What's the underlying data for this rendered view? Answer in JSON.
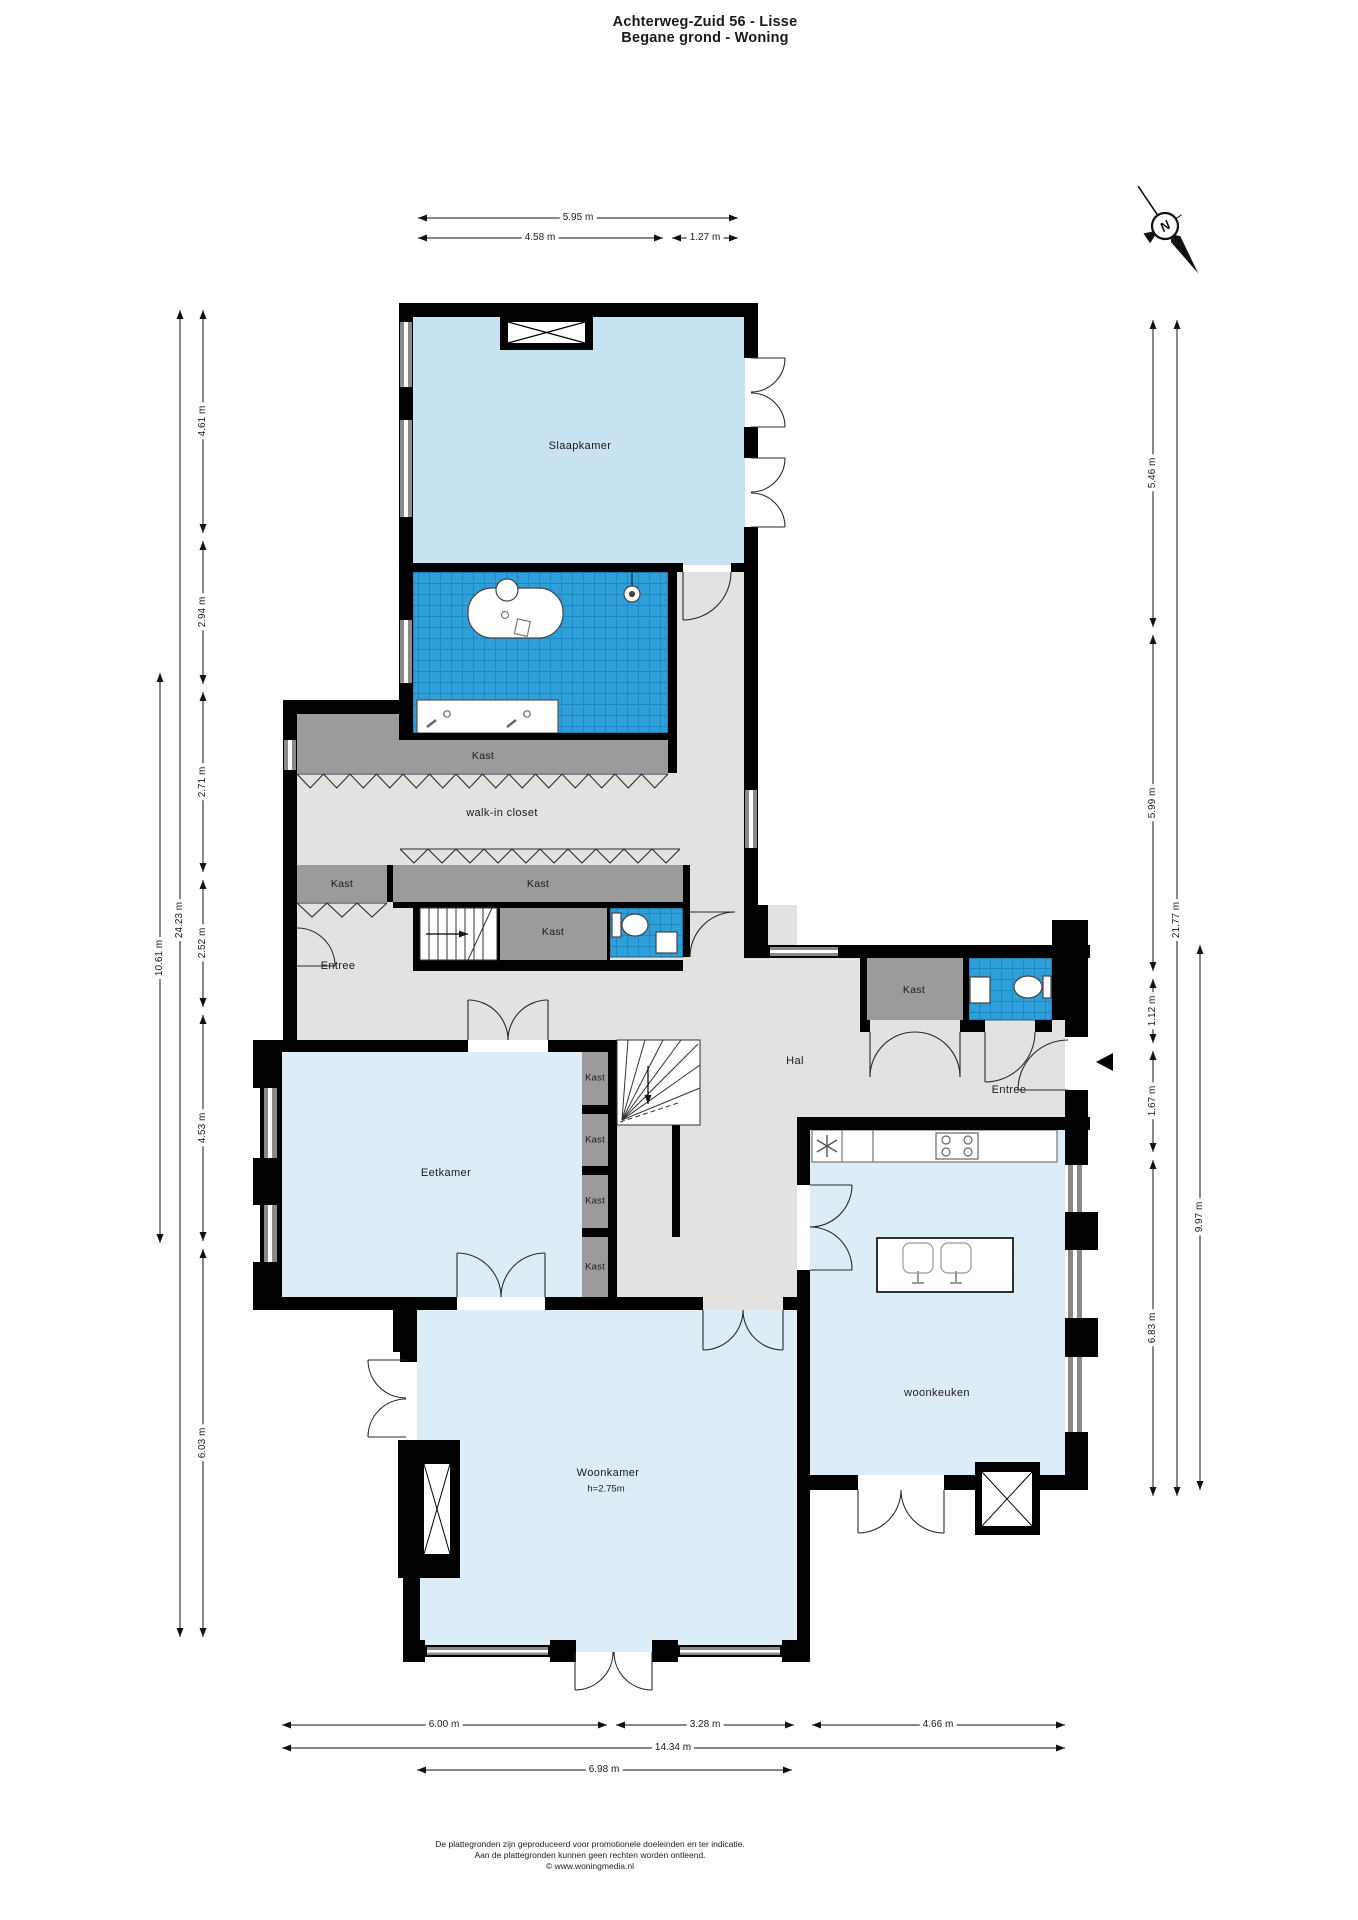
{
  "title": {
    "line1": "Achterweg-Zuid 56 - Lisse",
    "line2": "Begane grond - Woning"
  },
  "compass": {
    "north_label": "N"
  },
  "rooms": {
    "slaapkamer": "Slaapkamer",
    "walk_in_closet": "walk-in closet",
    "kast": "Kast",
    "entree": "Entree",
    "hal": "Hal",
    "eetkamer": "Eetkamer",
    "woonkeuken": "woonkeuken",
    "woonkamer": "Woonkamer",
    "woonkamer_ceiling_height": "h=2.75m"
  },
  "dimensions": {
    "top": {
      "total": "5.95 m",
      "left": "4.58 m",
      "right": "1.27 m"
    },
    "left": {
      "outer_total": "10.61 m",
      "total": "24.23 m",
      "segments": [
        "4.61 m",
        "2.94 m",
        "2.71 m",
        "2.52 m",
        "4.53 m",
        "6.03 m"
      ]
    },
    "right": {
      "segments": [
        "5.46 m",
        "5.99 m",
        "1.12 m",
        "1.67 m",
        "6.83 m"
      ],
      "total": "21.77 m",
      "lower_total": "9.97 m"
    },
    "bottom": {
      "row1": [
        "6.00 m",
        "3.28 m",
        "4.66 m"
      ],
      "total": "14.34 m",
      "woonkamer_width": "6.98 m"
    }
  },
  "footer": {
    "line1": "De plattegronden zijn geproduceerd voor promotionele doeleinden en ter indicatie.",
    "line2": "Aan de plattegronden kunnen geen rechten worden ontleend.",
    "line3": "© www.woningmedia.nl"
  },
  "colors": {
    "wall": "#000000",
    "bedroom_fill": "#c7e2f0",
    "room_fill": "#dcedf7",
    "floor_gray": "#e3e2df",
    "closet_gray": "#9b9b9b",
    "tile_blue": "#2f9fd9",
    "tile_grid": "#1b7fb8",
    "window_gray": "#8a8a8a"
  }
}
